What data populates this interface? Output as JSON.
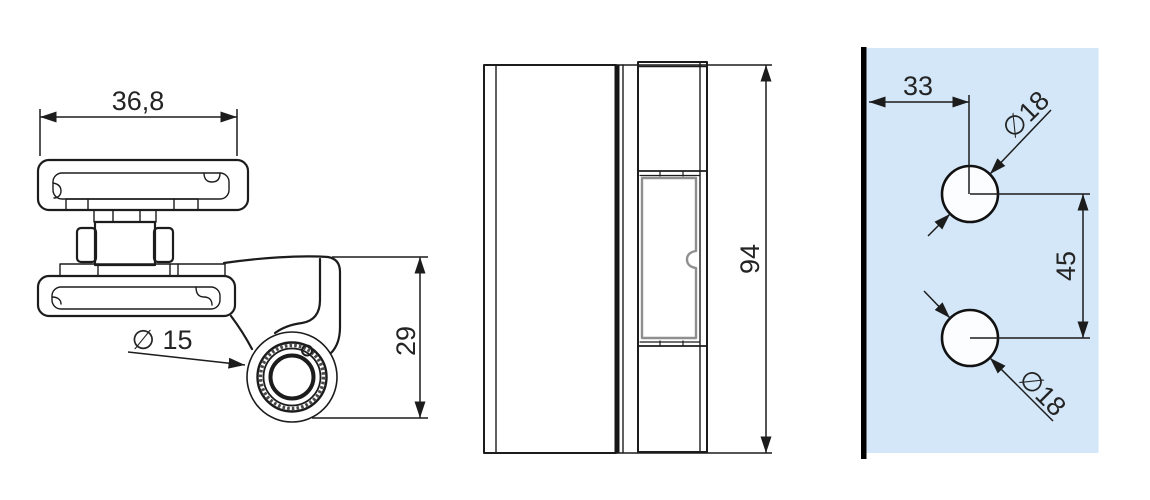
{
  "drawing": {
    "background": "#ffffff",
    "line_color": "#1c1c1c",
    "views": {
      "side_view": {
        "dim_width_label": "36,8",
        "dim_bore_label": "∅ 15",
        "dim_height_label": "29"
      },
      "front_view": {
        "dim_height_label": "94"
      },
      "drill_template": {
        "panel_color": "#d3e7f8",
        "edge_bar_color": "#000000",
        "hole_fill_color": "#fbfdff",
        "dim_edge_offset_label": "33",
        "dim_top_hole_label": "∅18",
        "dim_hole_spacing_label": "45",
        "dim_bottom_hole_label": "∅18"
      }
    }
  }
}
